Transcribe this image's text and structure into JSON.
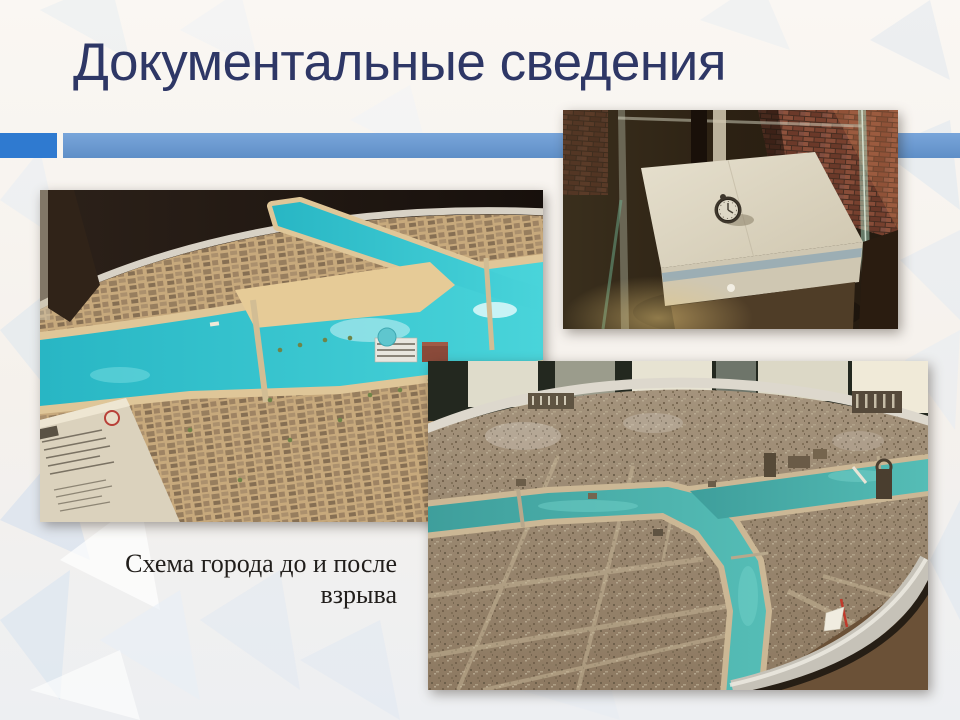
{
  "slide": {
    "title": "Документальные сведения",
    "caption_lines": [
      "Схема города до и после",
      "взрыва"
    ],
    "colors": {
      "title_color": "#2e3766",
      "caption_color": "#211e1b",
      "accent_left": "#2f7ad0",
      "accent_right_top": "#79a5da",
      "accent_right_bottom": "#5f8fc7",
      "background": "#f7f3ee"
    }
  }
}
